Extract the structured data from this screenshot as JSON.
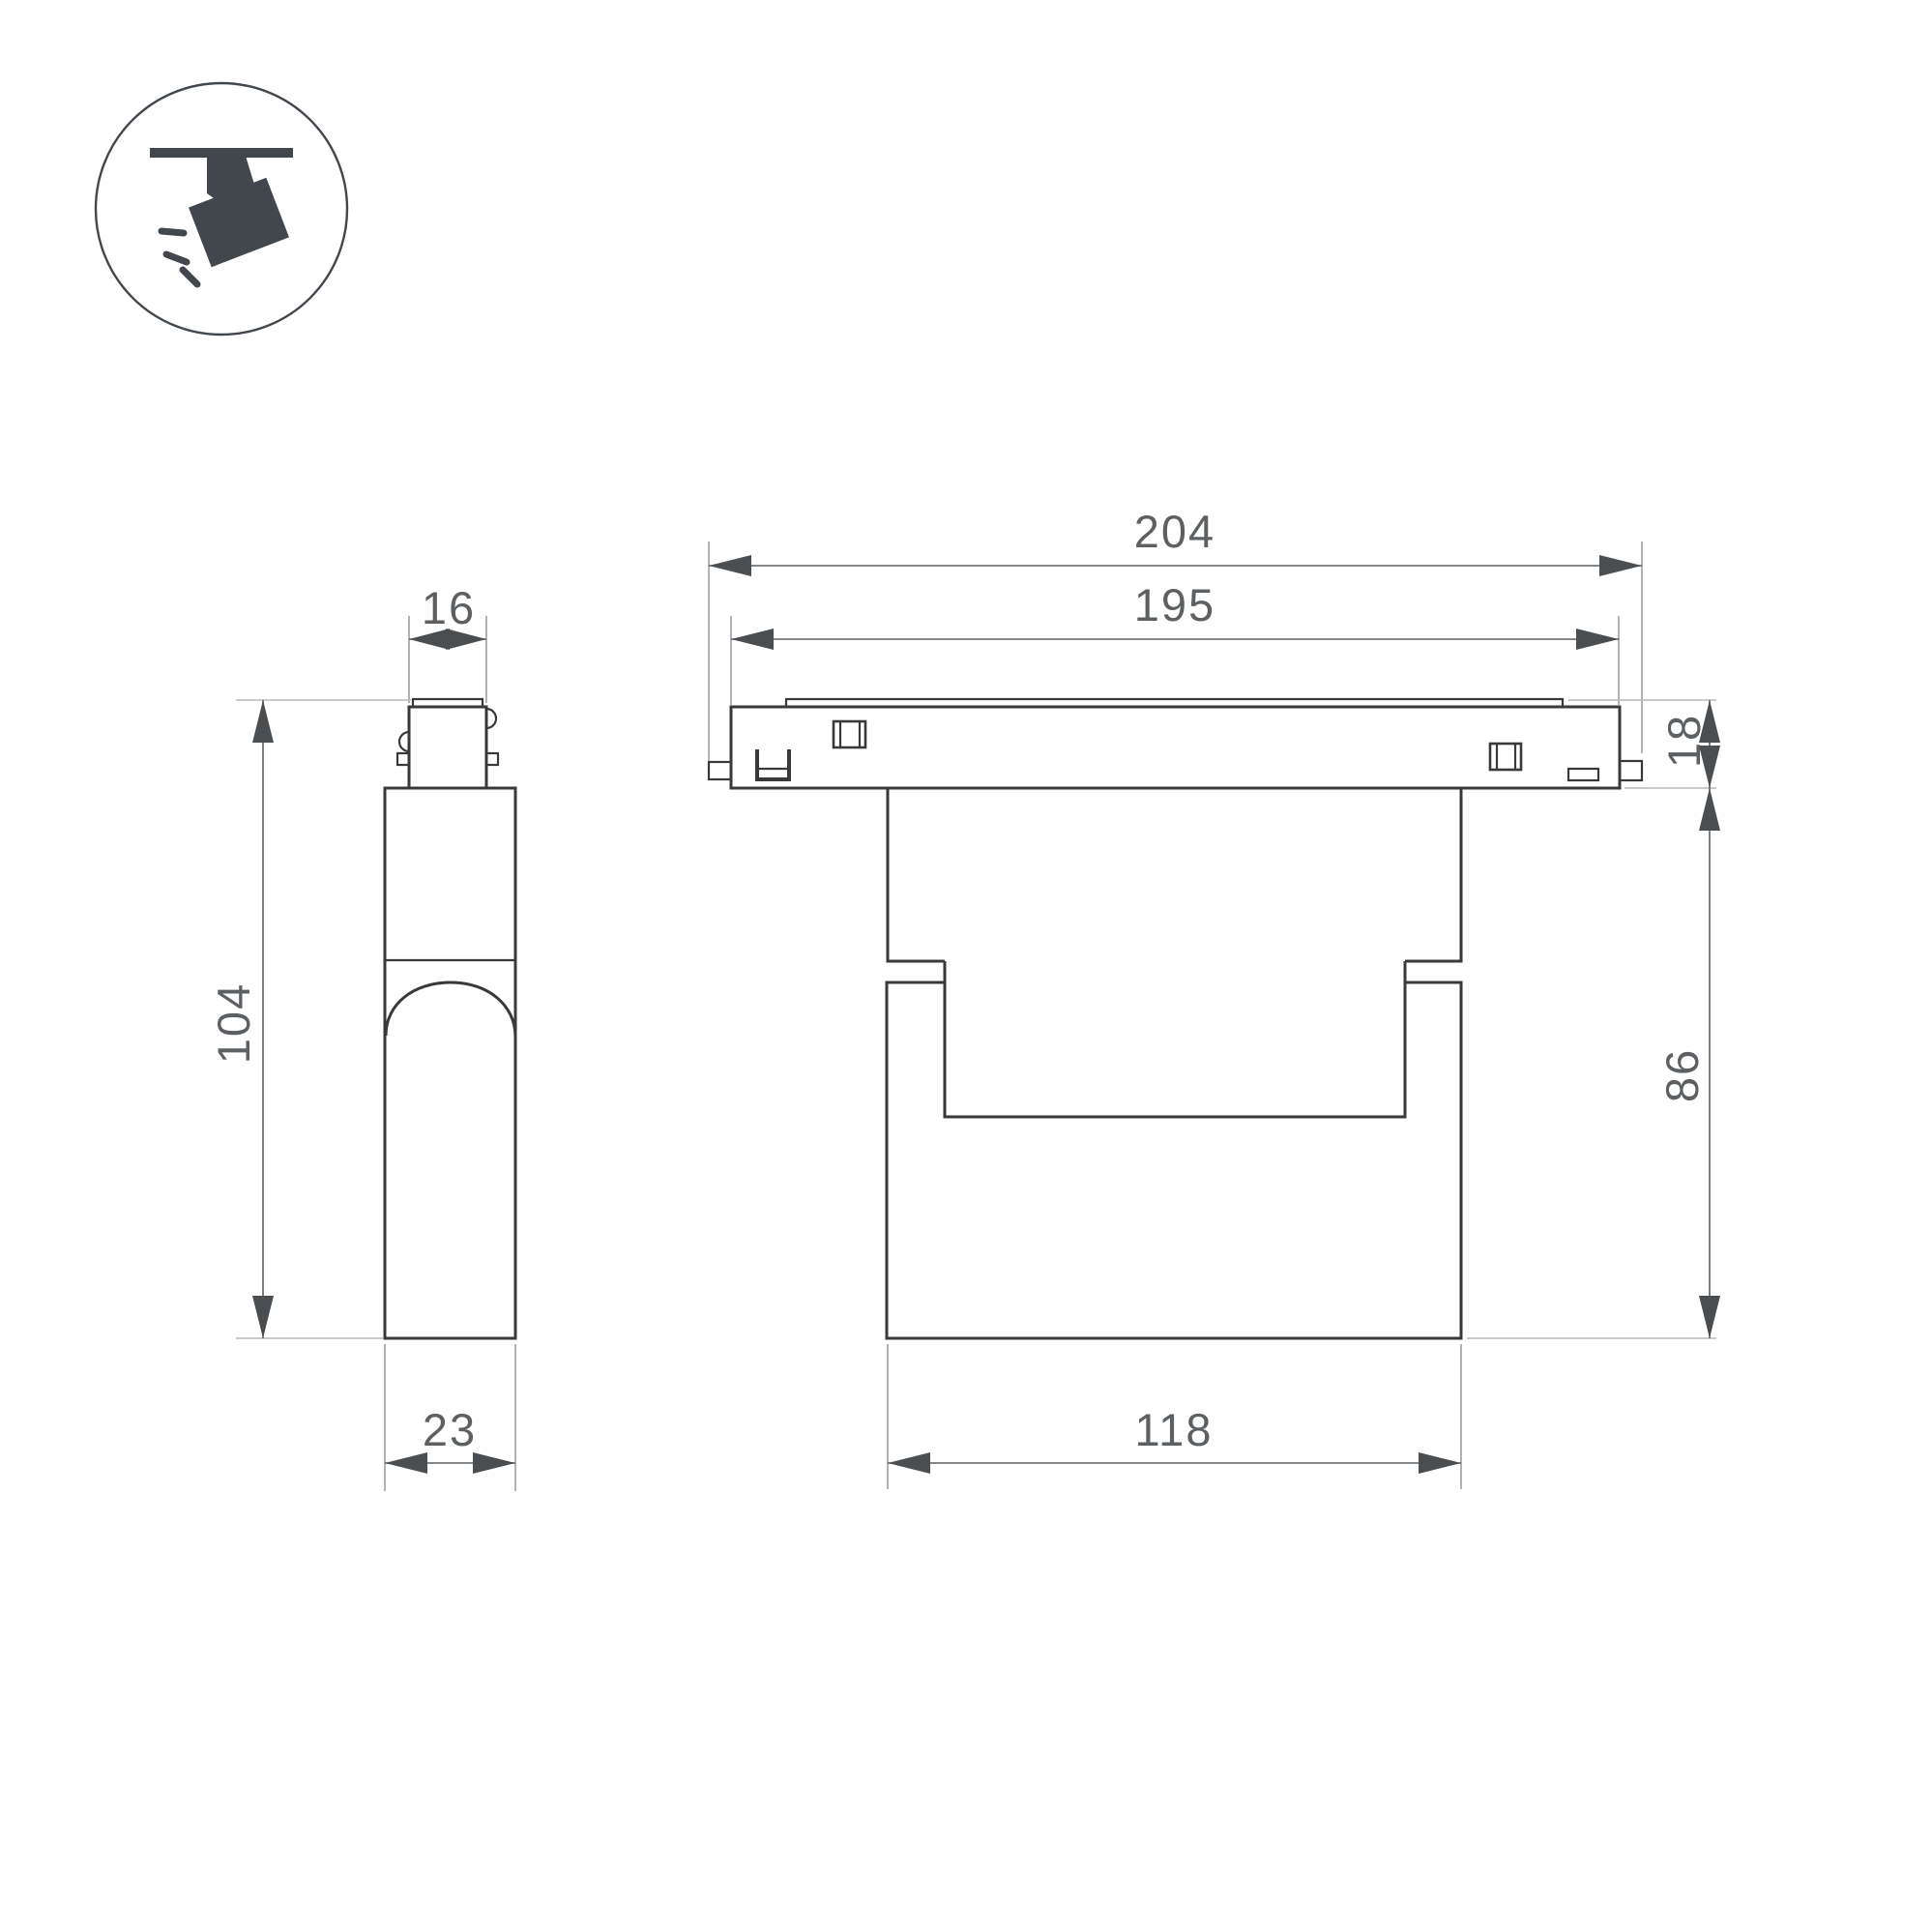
{
  "icon": {
    "name": "track-spotlight-icon",
    "description": "ceiling track with tilted spotlight and light rays"
  },
  "views": {
    "side_view": "fixture side profile",
    "front_view": "fixture front profile with track"
  },
  "dimensions": {
    "track_length": "204",
    "track_window": "195",
    "adapter_width": "16",
    "track_height": "18",
    "fixture_height": "104",
    "body_height": "86",
    "body_depth": "23",
    "body_width": "118"
  },
  "colors": {
    "background": "#ffffff",
    "line": "#37393b",
    "dim": "#5d6063",
    "ext": "#96999c",
    "extlight": "#b5b8ba",
    "arrow": "#4b4e51",
    "text": "#5d6063",
    "icon": "#41474d"
  }
}
